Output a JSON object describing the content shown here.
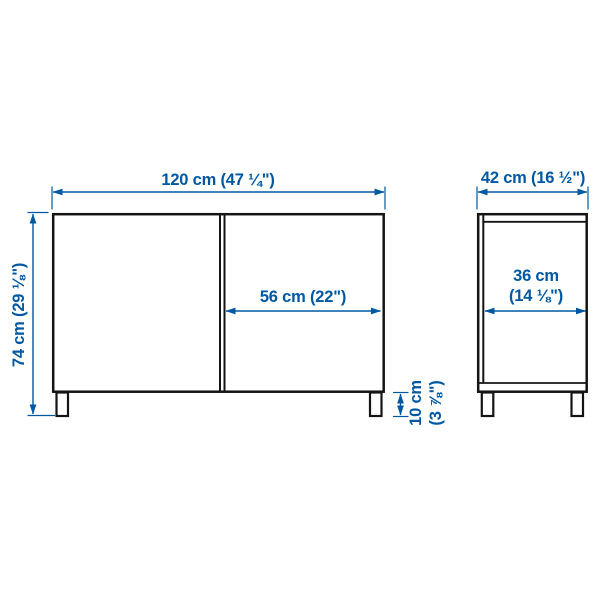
{
  "diagram": {
    "type": "furniture-dimension-drawing",
    "views": {
      "front": {
        "labels": {
          "overall_width": "120 cm (47 ¼\")",
          "overall_height": "74 cm (29 ⅛\")",
          "door_width": "56 cm (22\")",
          "leg_height": [
            "10 cm",
            "(3 ⅞\")"
          ]
        }
      },
      "side": {
        "labels": {
          "overall_depth": "42 cm (16 ½\")",
          "inner_depth": [
            "36 cm",
            "(14 ⅛\")"
          ]
        }
      }
    },
    "colors": {
      "dimension_blue": "#0058a3",
      "outline_black": "#141414",
      "background": "#ffffff"
    }
  }
}
